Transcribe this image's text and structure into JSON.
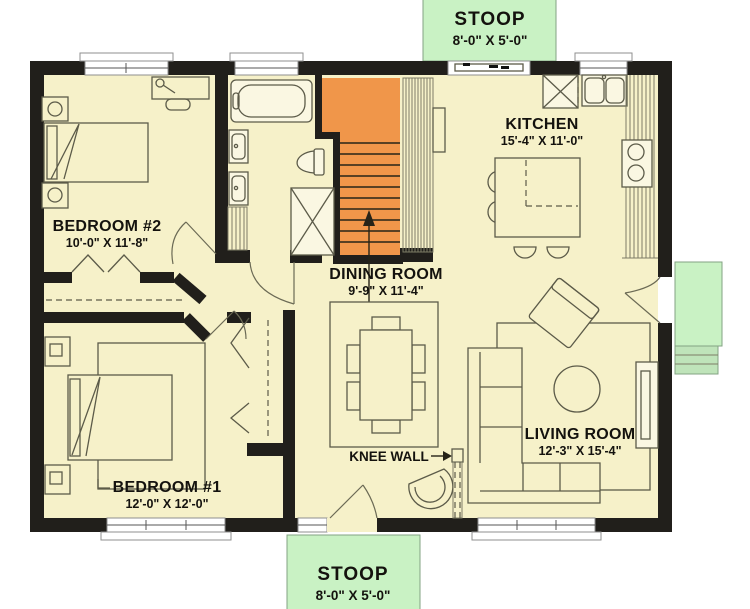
{
  "title": "Single-story house floor plan",
  "colors": {
    "floor": "#f6f1c9",
    "wall": "#211f1b",
    "stairs_orange": "#f0964a",
    "stoop_green": "#c9f2c4",
    "stoop_steps_green": "#bfe4ba",
    "furniture_line": "#5c5b49",
    "label_text": "#14120e"
  },
  "labels": {
    "stoop_top": {
      "name": "STOOP",
      "dims": "8'-0\" X 5'-0\""
    },
    "stoop_bottom": {
      "name": "STOOP",
      "dims": "8'-0\" X 5'-0\""
    },
    "kitchen": {
      "name": "KITCHEN",
      "dims": "15'-4\" X 11'-0\""
    },
    "bedroom2": {
      "name": "BEDROOM #2",
      "dims": "10'-0\" X 11'-8\""
    },
    "dining": {
      "name": "DINING ROOM",
      "dims": "9'-9\" X 11'-4\""
    },
    "bedroom1": {
      "name": "BEDROOM #1",
      "dims": "12'-0\" X 12'-0\""
    },
    "living": {
      "name": "LIVING ROOM",
      "dims": "12'-3\" X 15'-4\""
    },
    "knee_wall": {
      "name": "KNEE WALL"
    }
  },
  "features": [
    "orange staircase with up arrow",
    "knee wall between entry and living room",
    "bathroom with tub, double vanity, toilet, shower",
    "kitchen island with four stools",
    "sectional sofa",
    "dining table with six chairs",
    "right-side deck with steps"
  ]
}
